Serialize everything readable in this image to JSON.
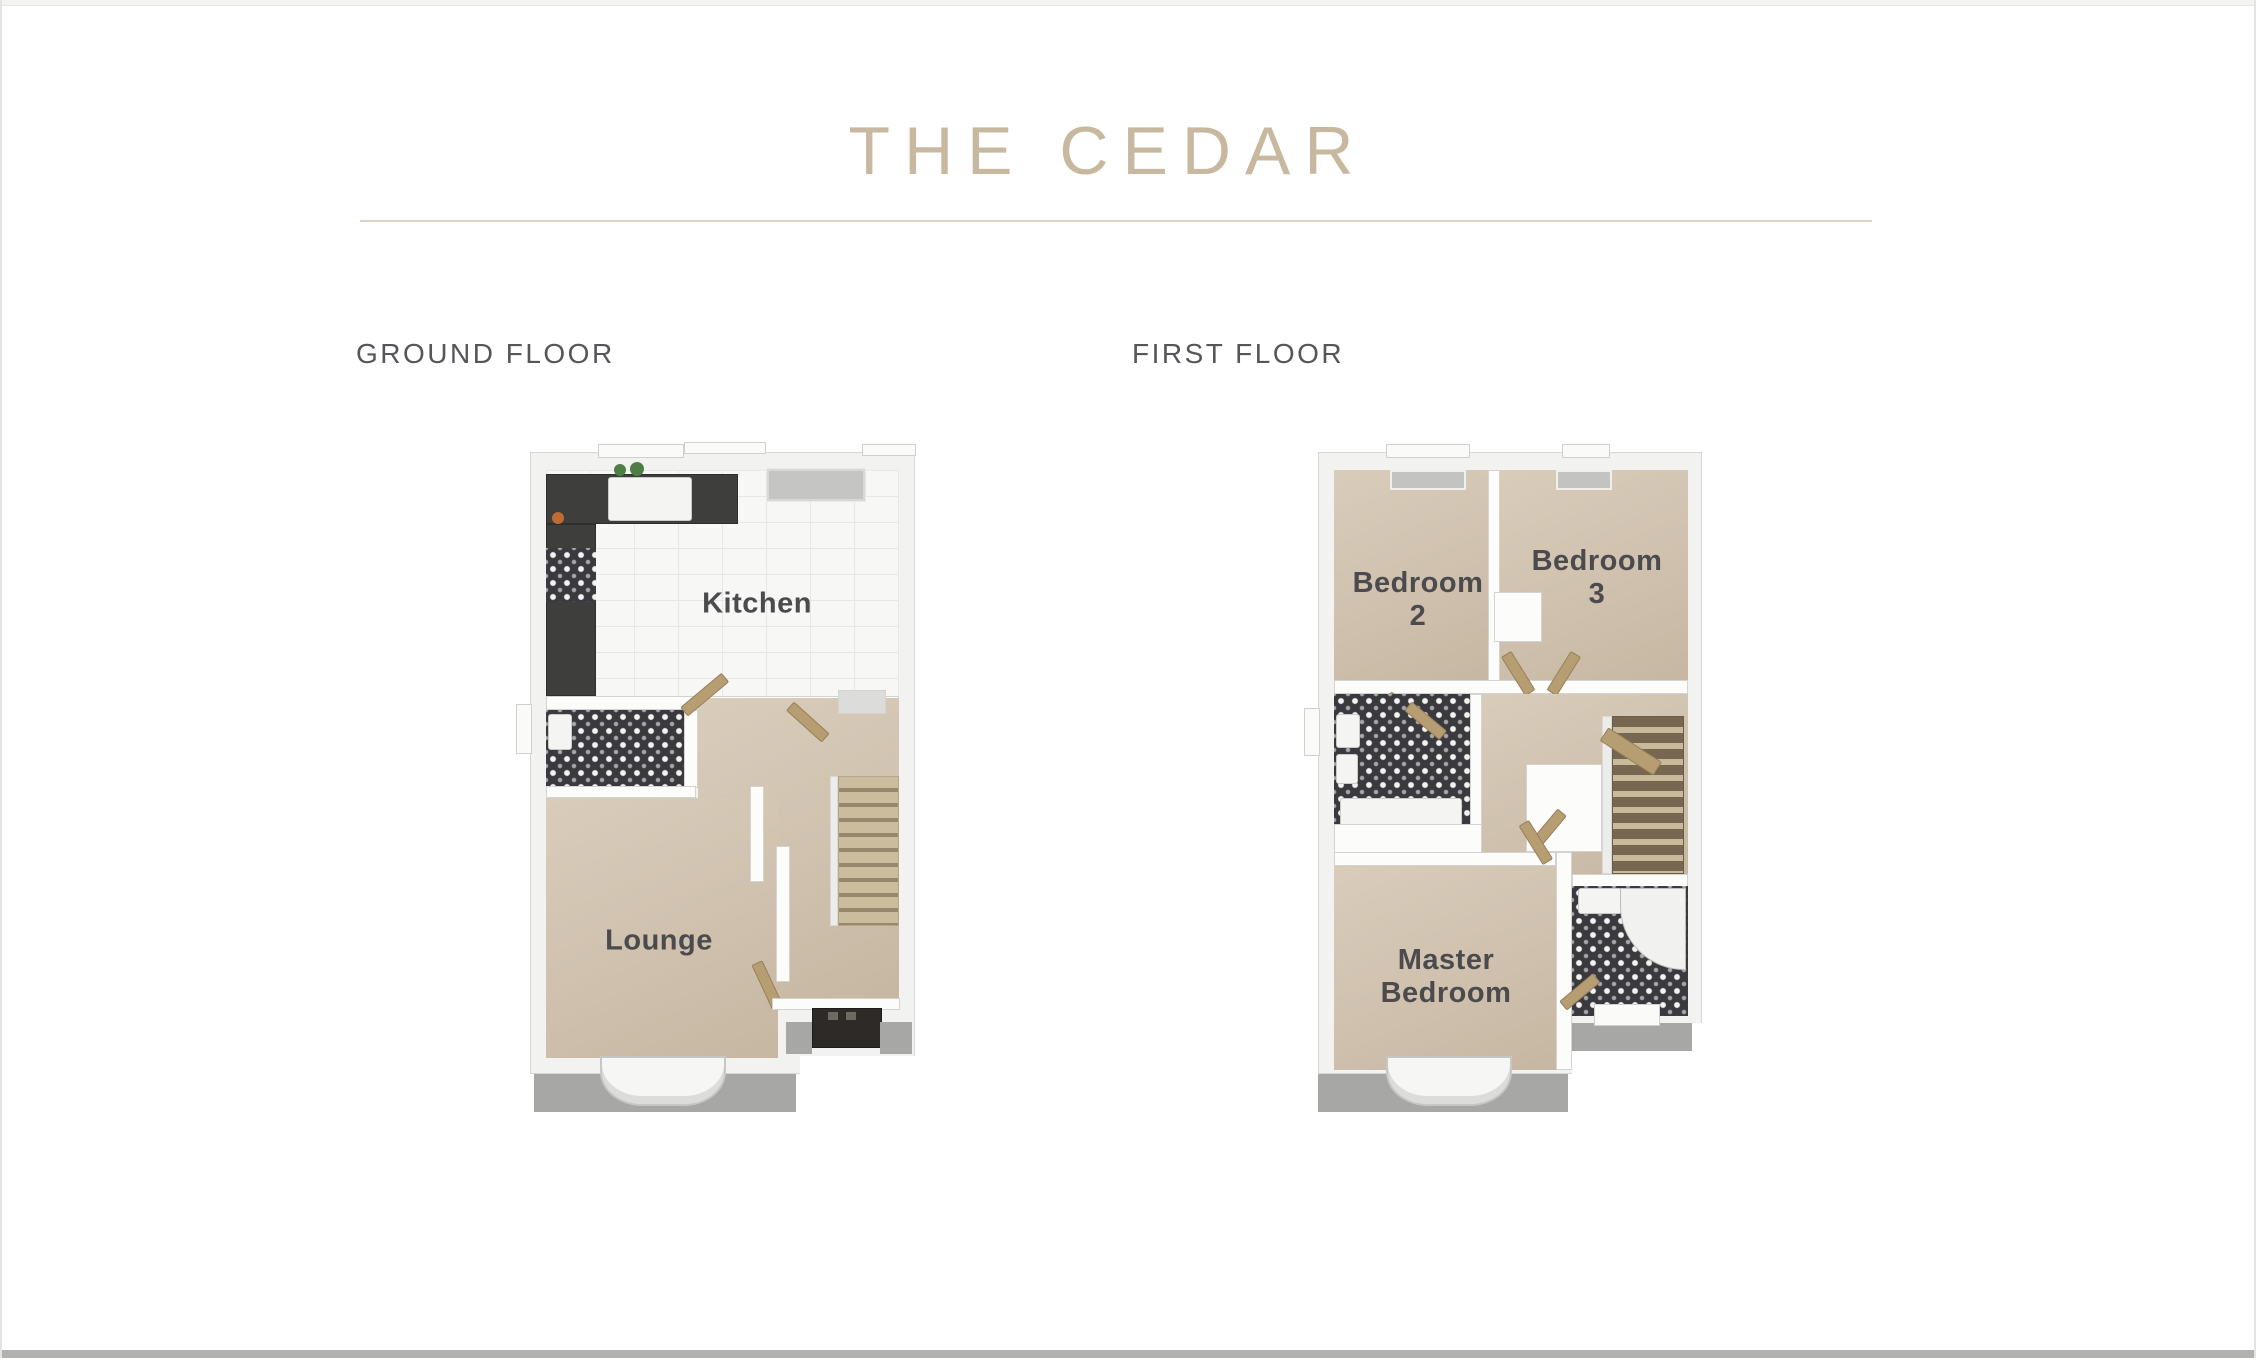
{
  "header": {
    "title": "THE CEDAR"
  },
  "sections": {
    "ground": {
      "label": "GROUND FLOOR"
    },
    "first": {
      "label": "FIRST FLOOR"
    }
  },
  "rooms": {
    "kitchen": "Kitchen",
    "lounge": "Lounge",
    "bedroom2_l1": "Bedroom",
    "bedroom2_l2": "2",
    "bedroom3_l1": "Bedroom",
    "bedroom3_l2": "3",
    "master_l1": "Master",
    "master_l2": "Bedroom"
  },
  "colors": {
    "accent_tan": "#c7b89f",
    "divider": "#dad3c7",
    "section_label_gray": "#55555a",
    "room_label_gray": "#4b4b4e",
    "carpet_beige": "#d2c4b1",
    "kitchen_tile_white": "#f7f7f6",
    "patterned_tile_dark": "#3a3a3e",
    "counter_dark": "#3e3e3c",
    "wood_door_tan": "#b79d72",
    "exterior_paving_gray": "#a7a7a5",
    "front_door_dark": "#2d2a27"
  }
}
